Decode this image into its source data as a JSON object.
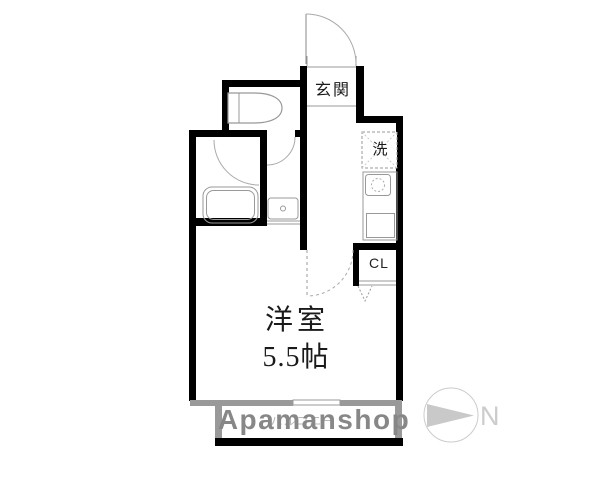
{
  "labels": {
    "entrance": "玄関",
    "washer": "洗",
    "closet": "CL",
    "room_name": "洋室",
    "room_size": "5.5帖",
    "balcony": "バルコニー"
  },
  "watermark": "Apamanshop",
  "compass": {
    "north": "N"
  },
  "colors": {
    "wall": "#000000",
    "balcony_wall": "#999999",
    "watermark_gray": "#878787",
    "balcony_text": "#b9b9b9",
    "compass_gray": "#cccccc",
    "fixture_line": "#999999",
    "door_arc": "#aaaaaa",
    "label_text": "#1a1a1a"
  }
}
